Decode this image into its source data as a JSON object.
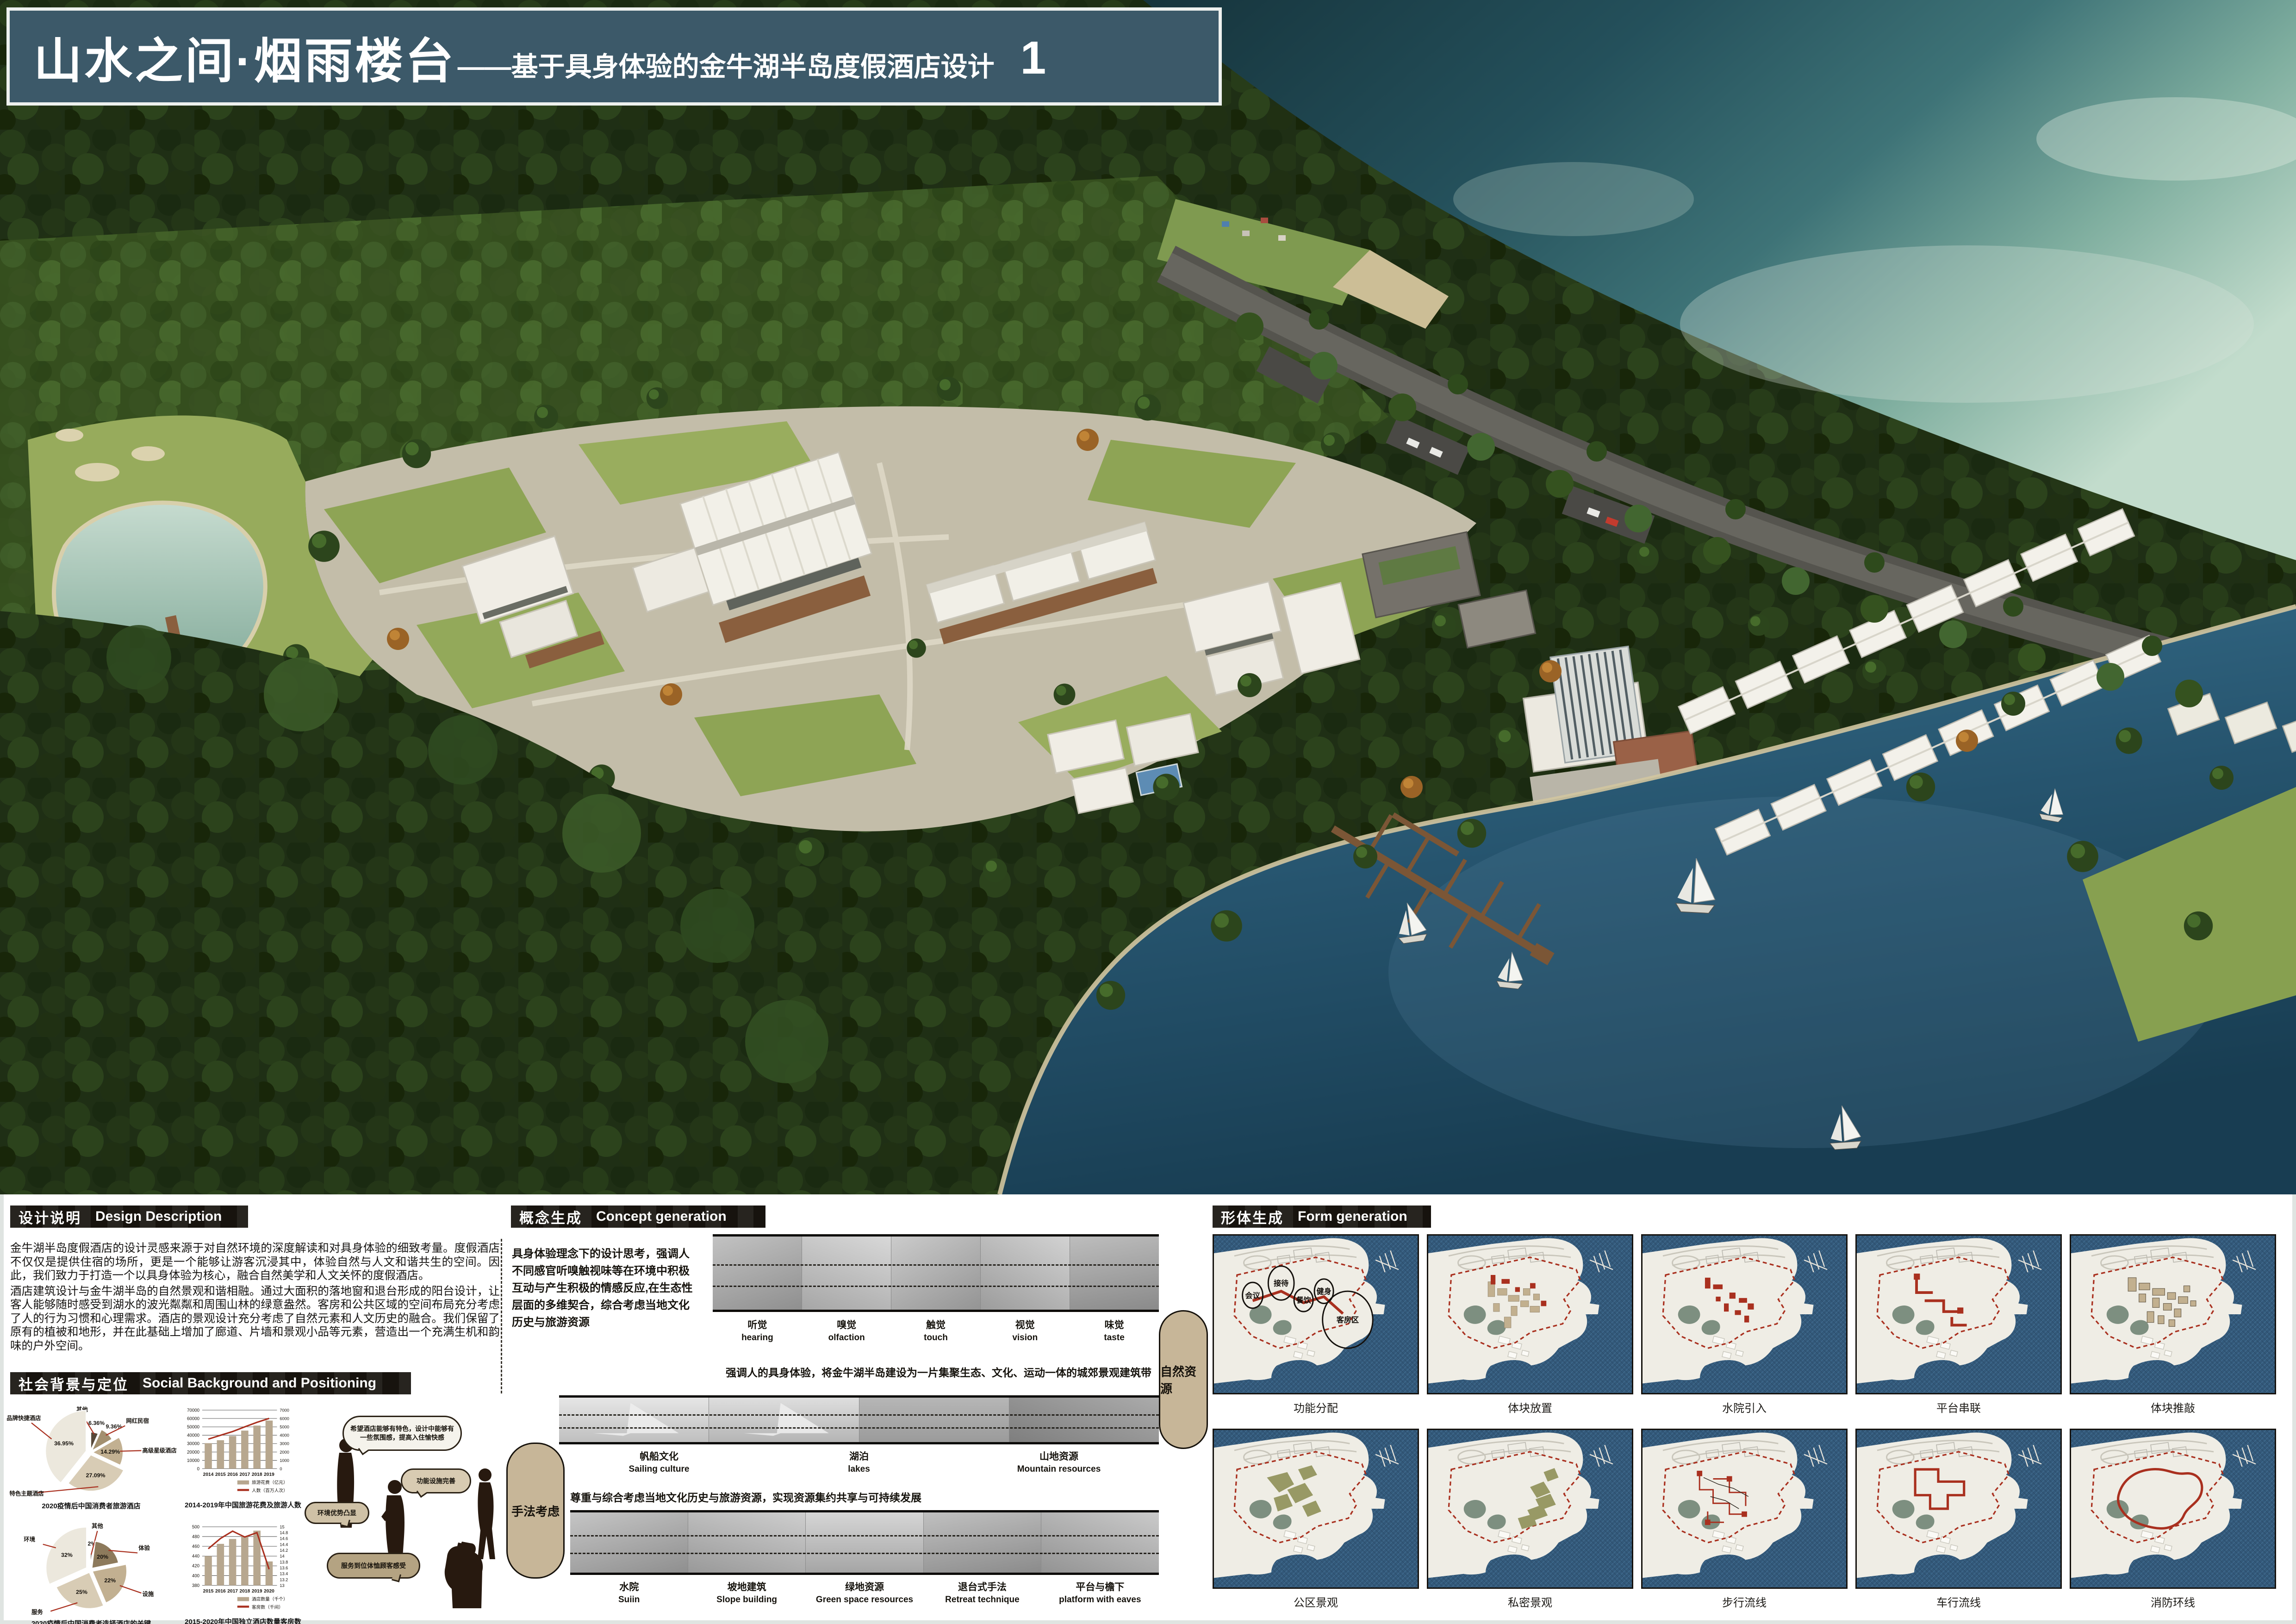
{
  "banner": {
    "main": "山水之间·烟雨楼台",
    "sub": "——基于具身体验的金牛湖半岛度假酒店设计",
    "page": "1"
  },
  "design_description": {
    "zh": "设计说明",
    "en": "Design Description",
    "p1": "金牛湖半岛度假酒店的设计灵感来源于对自然环境的深度解读和对具身体验的细致考量。度假酒店不仅仅是提供住宿的场所，更是一个能够让游客沉浸其中，体验自然与人文和谐共生的空间。因此，我们致力于打造一个以具身体验为核心，融合自然美学和人文关怀的度假酒店。",
    "p2": "酒店建筑设计与金牛湖半岛的自然景观和谐相融。通过大面积的落地窗和退台形成的阳台设计，让客人能够随时感受到湖水的波光粼粼和周围山林的绿意盎然。客房和公共区域的空间布局充分考虑了人的行为习惯和心理需求。酒店的景观设计充分考虑了自然元素和人文历史的融合。我们保留了原有的植被和地形，并在此基础上增加了廊道、片墙和景观小品等元素，营造出一个充满生机和韵味的户外空间。"
  },
  "social": {
    "zh": "社会背景与定位",
    "en": "Social Background and Positioning",
    "bubble1": "希望酒店能够有特色，设计中能够有一些氛围感，提高入住愉快感",
    "bubble2": "功能设施完善",
    "bubble3": "环境优势凸显",
    "bubble4": "服务到位体恤顾客感受"
  },
  "concept": {
    "zh": "概念生成",
    "en": "Concept generation",
    "intro": "具身体验理念下的设计思考，强调人不同感官听嗅触视味等在环境中积极互动与产生积极的情感反应,在生态性层面的多维契合，综合考虑当地文化历史与旅游资源",
    "senses": [
      {
        "zh": "听觉",
        "en": "hearing"
      },
      {
        "zh": "嗅觉",
        "en": "olfaction"
      },
      {
        "zh": "触觉",
        "en": "touch"
      },
      {
        "zh": "视觉",
        "en": "vision"
      },
      {
        "zh": "味觉",
        "en": "taste"
      }
    ],
    "statement1": "强调人的具身体验，将金牛湖半岛建设为一片集聚生态、文化、运动一体的城郊景观建筑带",
    "natural_label": "自然资源",
    "resources": [
      {
        "zh": "帆船文化",
        "en": "Sailing culture"
      },
      {
        "zh": "湖泊",
        "en": "lakes"
      },
      {
        "zh": "山地资源",
        "en": "Mountain resources"
      }
    ],
    "statement2": "尊重与综合考虑当地文化历史与旅游资源，实现资源集约共享与可持续发展",
    "technique_label": "手法考虑",
    "techniques": [
      {
        "zh": "水院",
        "en": "Suiin"
      },
      {
        "zh": "坡地建筑",
        "en": "Slope building"
      },
      {
        "zh": "绿地资源",
        "en": "Green space resources"
      },
      {
        "zh": "退台式手法",
        "en": "Retreat technique"
      },
      {
        "zh": "平台与檐下",
        "en": "platform with eaves"
      }
    ]
  },
  "form": {
    "zh": "形体生成",
    "en": "Form generation",
    "function_labels": [
      "会议",
      "接待",
      "餐饮",
      "健身",
      "客房区"
    ],
    "steps": [
      "功能分配",
      "体块放置",
      "水院引入",
      "平台串联",
      "体块推敲",
      "公区景观",
      "私密景观",
      "步行流线",
      "车行流线",
      "消防环线"
    ]
  },
  "colors": {
    "banner": "#3c5969",
    "accent_red": "#a9301f",
    "bar_tan": "#b7a78f",
    "map_water": "#33597a",
    "map_land": "#efede5",
    "pie_palettes": [
      [
        "#ece8dd",
        "#d8ccb5",
        "#c2b091",
        "#a3906f",
        "#57493a"
      ],
      [
        "#ece8dd",
        "#d8ccb5",
        "#c2b091",
        "#8d7a5c",
        "#57493a"
      ]
    ]
  },
  "chart_data": [
    {
      "id": "pie_consumer_hotel_types",
      "type": "pie",
      "title": "2020疫情后中国消费者旅游酒店",
      "slices": [
        {
          "label": "品牌快捷酒店",
          "value": 36.95
        },
        {
          "label": "特色主题酒店",
          "value": 27.09
        },
        {
          "label": "高级星级酒店",
          "value": 14.29
        },
        {
          "label": "网红民宿",
          "value": 9.36
        },
        {
          "label": "其他",
          "value": 6.36
        }
      ]
    },
    {
      "id": "bar_tourism_spending",
      "type": "bar+line",
      "title": "2014-2019年中国旅游花费及旅游人数",
      "categories": [
        "2014",
        "2015",
        "2016",
        "2017",
        "2018",
        "2019"
      ],
      "series": [
        {
          "name": "旅游花费（亿元）",
          "type": "bar",
          "axis": "left",
          "values": [
            30500,
            34000,
            39000,
            45500,
            51500,
            57500
          ]
        },
        {
          "name": "人数（百万人次）",
          "type": "line",
          "axis": "right",
          "values": [
            3530,
            3990,
            4440,
            5000,
            5540,
            6010
          ]
        }
      ],
      "left_axis": {
        "min": 0,
        "max": 70000,
        "step": 10000
      },
      "right_axis": {
        "min": 0,
        "max": 7000,
        "step": 1000
      }
    },
    {
      "id": "pie_hotel_choice_keys",
      "type": "pie",
      "title": "2020疫情后中国消费者选择酒店的关键",
      "slices": [
        {
          "label": "环境",
          "value": 32
        },
        {
          "label": "服务",
          "value": 25
        },
        {
          "label": "设施",
          "value": 22
        },
        {
          "label": "体验",
          "value": 20
        },
        {
          "label": "其他",
          "value": 2
        }
      ]
    },
    {
      "id": "bar_independent_hotels",
      "type": "bar+line",
      "title": "2015-2020年中国独立酒店数量客房数",
      "categories": [
        "2015",
        "2016",
        "2017",
        "2018",
        "2019",
        "2020"
      ],
      "series": [
        {
          "name": "酒店数量（千个）",
          "type": "bar",
          "axis": "left",
          "values": [
            440,
            465,
            475,
            481,
            492,
            429
          ]
        },
        {
          "name": "客房数（千间）",
          "type": "line",
          "axis": "right",
          "values": [
            14.25,
            14.6,
            14.85,
            14.65,
            14.8,
            13.55
          ]
        }
      ],
      "left_axis": {
        "min": 380,
        "max": 500,
        "step": 20
      },
      "right_axis": {
        "min": 13,
        "max": 15,
        "step": 0.2
      }
    }
  ]
}
